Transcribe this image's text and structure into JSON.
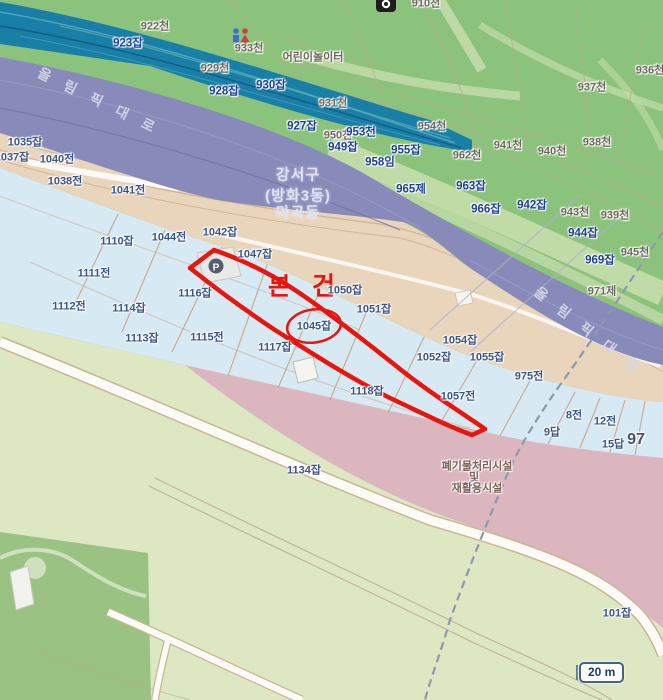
{
  "app": {
    "type": "cadastral-map-viewer",
    "region": "Gangseo-gu Magok-dong"
  },
  "palette": {
    "green": "#8cc37c",
    "pale-path": "#c3dca9",
    "pale-band": "#cfe3b4",
    "teal": "#1a7fa6",
    "teal-line-light": "#4ba3c4",
    "teal-line-dark": "#0f5e86",
    "purple": "#888aba",
    "tan": "#e9d5bc",
    "lightblue": "#d7e9f2",
    "bottomgreen": "#dde7c2",
    "darkgreen-patch": "#9ac383",
    "pink": "#dcb6bf",
    "parcel-line": "#c2a38b",
    "road-white": "#fcfbf7",
    "red": "#e8150f",
    "lbl-green": "#6b675c",
    "lbl-navy": "#3b5588",
    "lbl-blue": "#1c3f9c",
    "lbl-road": "#d4d6e8",
    "lbl-district": "#dfe2f2",
    "lbl-facility": "#7a6258"
  },
  "subject": {
    "marker_text": "본 건",
    "parcel_text": "1045잡"
  },
  "scale_bar": {
    "label": "20 m"
  },
  "poi": {
    "parking_label": "P"
  },
  "district_label": {
    "line1": "강서구",
    "line2": "(방화3동)",
    "line3": "마곡동"
  },
  "facility_label": {
    "line1": "폐기물처리시설",
    "line2": "및",
    "line3": "재활용시설"
  },
  "road_labels": [
    {
      "t": "올 림 픽 대 로",
      "x": 99,
      "y": 101,
      "r": 26
    },
    {
      "t": "올 림 픽 대 로",
      "x": 589,
      "y": 331,
      "r": 38
    }
  ],
  "labels": [
    {
      "t": "922천",
      "x": 155,
      "y": 27,
      "c": "g"
    },
    {
      "t": "933천",
      "x": 249,
      "y": 49,
      "c": "g"
    },
    {
      "t": "어린이놀이터",
      "x": 313,
      "y": 58,
      "c": "g"
    },
    {
      "t": "929천",
      "x": 215,
      "y": 69,
      "c": "g"
    },
    {
      "t": "931천",
      "x": 333,
      "y": 104,
      "c": "g"
    },
    {
      "t": "910천",
      "x": 426,
      "y": 4,
      "c": "g"
    },
    {
      "t": "936천",
      "x": 650,
      "y": 71,
      "c": "g"
    },
    {
      "t": "937천",
      "x": 592,
      "y": 88,
      "c": "g"
    },
    {
      "t": "950천",
      "x": 338,
      "y": 136,
      "c": "g"
    },
    {
      "t": "954천",
      "x": 432,
      "y": 127,
      "c": "g"
    },
    {
      "t": "962천",
      "x": 467,
      "y": 156,
      "c": "g"
    },
    {
      "t": "941천",
      "x": 508,
      "y": 146,
      "c": "g"
    },
    {
      "t": "940천",
      "x": 552,
      "y": 152,
      "c": "g"
    },
    {
      "t": "938천",
      "x": 597,
      "y": 143,
      "c": "g"
    },
    {
      "t": "943천",
      "x": 575,
      "y": 213,
      "c": "g"
    },
    {
      "t": "939천",
      "x": 615,
      "y": 216,
      "c": "g"
    },
    {
      "t": "945천",
      "x": 635,
      "y": 253,
      "c": "g"
    },
    {
      "t": "971제",
      "x": 602,
      "y": 292,
      "c": "g"
    },
    {
      "t": "101잡",
      "x": 617,
      "y": 614,
      "c": "n"
    },
    {
      "t": "923잡",
      "x": 128,
      "y": 44,
      "c": "b"
    },
    {
      "t": "928잡",
      "x": 224,
      "y": 92,
      "c": "b"
    },
    {
      "t": "930잡",
      "x": 271,
      "y": 86,
      "c": "b"
    },
    {
      "t": "927잡",
      "x": 302,
      "y": 127,
      "c": "b"
    },
    {
      "t": "953천",
      "x": 361,
      "y": 133,
      "c": "b"
    },
    {
      "t": "949잡",
      "x": 343,
      "y": 148,
      "c": "b"
    },
    {
      "t": "955잡",
      "x": 406,
      "y": 151,
      "c": "b"
    },
    {
      "t": "958임",
      "x": 380,
      "y": 163,
      "c": "b"
    },
    {
      "t": "965제",
      "x": 411,
      "y": 190,
      "c": "b"
    },
    {
      "t": "963잡",
      "x": 471,
      "y": 187,
      "c": "b"
    },
    {
      "t": "966잡",
      "x": 486,
      "y": 210,
      "c": "b"
    },
    {
      "t": "942잡",
      "x": 532,
      "y": 206,
      "c": "b"
    },
    {
      "t": "944잡",
      "x": 583,
      "y": 234,
      "c": "b"
    },
    {
      "t": "969잡",
      "x": 600,
      "y": 261,
      "c": "b"
    },
    {
      "t": "1035잡",
      "x": 25,
      "y": 143,
      "c": "n"
    },
    {
      "t": "1037잡",
      "x": 12,
      "y": 158,
      "c": "n"
    },
    {
      "t": "1040전",
      "x": 57,
      "y": 160,
      "c": "n"
    },
    {
      "t": "1038전",
      "x": 65,
      "y": 182,
      "c": "n"
    },
    {
      "t": "1041전",
      "x": 128,
      "y": 191,
      "c": "n"
    },
    {
      "t": "1044전",
      "x": 169,
      "y": 238,
      "c": "n"
    },
    {
      "t": "1042잡",
      "x": 220,
      "y": 233,
      "c": "n"
    },
    {
      "t": "1047잡",
      "x": 255,
      "y": 255,
      "c": "n"
    },
    {
      "t": "1110잡",
      "x": 117,
      "y": 242,
      "c": "n"
    },
    {
      "t": "1111전",
      "x": 94,
      "y": 274,
      "c": "n"
    },
    {
      "t": "1112전",
      "x": 69,
      "y": 307,
      "c": "n"
    },
    {
      "t": "1114잡",
      "x": 129,
      "y": 309,
      "c": "n"
    },
    {
      "t": "1113잡",
      "x": 142,
      "y": 339,
      "c": "n"
    },
    {
      "t": "1115전",
      "x": 207,
      "y": 338,
      "c": "n"
    },
    {
      "t": "1116잡",
      "x": 195,
      "y": 294,
      "c": "n"
    },
    {
      "t": "1117잡",
      "x": 275,
      "y": 348,
      "c": "n"
    },
    {
      "t": "1118잡",
      "x": 367,
      "y": 392,
      "c": "n"
    },
    {
      "t": "1050잡",
      "x": 345,
      "y": 291,
      "c": "n"
    },
    {
      "t": "1051잡",
      "x": 374,
      "y": 310,
      "c": "n"
    },
    {
      "t": "1052잡",
      "x": 434,
      "y": 358,
      "c": "n"
    },
    {
      "t": "1054잡",
      "x": 460,
      "y": 341,
      "c": "n"
    },
    {
      "t": "1055잡",
      "x": 487,
      "y": 358,
      "c": "n"
    },
    {
      "t": "1057전",
      "x": 458,
      "y": 397,
      "c": "n"
    },
    {
      "t": "975전",
      "x": 529,
      "y": 377,
      "c": "n"
    },
    {
      "t": "8전",
      "x": 574,
      "y": 416,
      "c": "n"
    },
    {
      "t": "12전",
      "x": 605,
      "y": 422,
      "c": "n"
    },
    {
      "t": "9답",
      "x": 552,
      "y": 433,
      "c": "n"
    },
    {
      "t": "15답",
      "x": 613,
      "y": 445,
      "c": "n"
    },
    {
      "t": "1045잡",
      "x": 314,
      "y": 327,
      "c": "n"
    },
    {
      "t": "1134잡",
      "x": 304,
      "y": 471,
      "c": "n"
    },
    {
      "t": "97",
      "x": 636,
      "y": 440,
      "c": "big"
    }
  ]
}
